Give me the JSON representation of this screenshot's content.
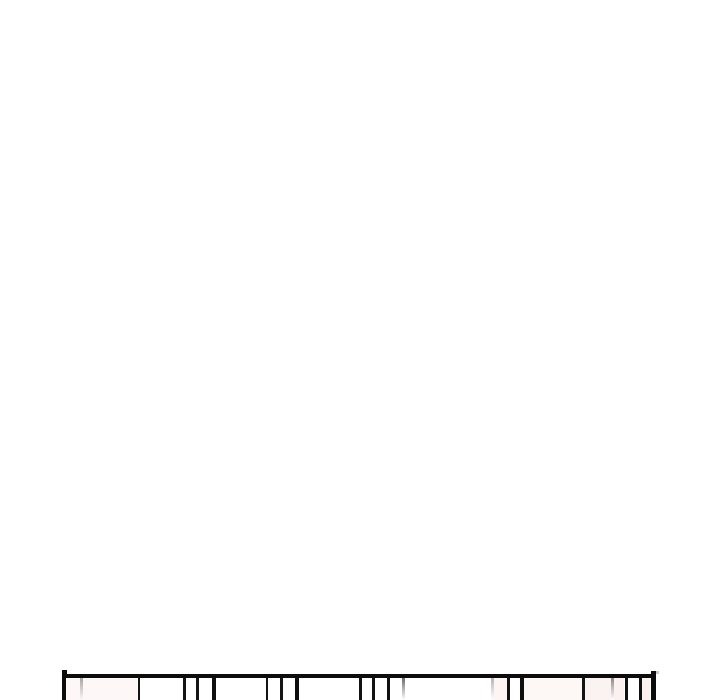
{
  "scene": {
    "kind": "comic-strip-segment",
    "description": "Mostly blank white vertical-scroll comic area; only the hand-drawn top edge of a panel with vertical slat lines is visible at the very bottom, cut off by the image edge.",
    "background_color": "#ffffff"
  },
  "panel": {
    "ink_color": "#0c0c0c",
    "fill_color": "#ffffff",
    "left": 62,
    "top": 674,
    "right": 656,
    "bottom_cropped": true,
    "borders": {
      "top": {
        "x": 62,
        "y": 674,
        "w": 594,
        "h": 4,
        "color": "#0c0c0c"
      },
      "left": {
        "x": 62,
        "y": 670,
        "w": 4.5,
        "h": 30,
        "color": "#0c0c0c"
      },
      "right": {
        "x": 650.5,
        "y": 671,
        "w": 5.5,
        "h": 29,
        "color": "#0c0c0c"
      }
    },
    "corner_notch": {
      "x": 656,
      "y": 671,
      "w": 3,
      "h": 3,
      "color": "#c9c5c5"
    },
    "lines": [
      {
        "x": 79.5,
        "w": 3,
        "color": "#a8a5a5",
        "type": "soft"
      },
      {
        "x": 137.5,
        "w": 2.5,
        "color": "#141414",
        "type": "solid"
      },
      {
        "x": 183,
        "w": 2.5,
        "color": "#141414",
        "type": "solid"
      },
      {
        "x": 196,
        "w": 2.5,
        "color": "#141414",
        "type": "solid"
      },
      {
        "x": 212,
        "w": 3.5,
        "color": "#0f0f0f",
        "type": "solid"
      },
      {
        "x": 265.5,
        "w": 2.5,
        "color": "#141414",
        "type": "solid"
      },
      {
        "x": 280,
        "w": 2.5,
        "color": "#141414",
        "type": "solid"
      },
      {
        "x": 295,
        "w": 3.5,
        "color": "#0f0f0f",
        "type": "solid"
      },
      {
        "x": 358.5,
        "w": 3,
        "color": "#121212",
        "type": "solid"
      },
      {
        "x": 372,
        "w": 3,
        "color": "#121212",
        "type": "solid"
      },
      {
        "x": 386.5,
        "w": 3.5,
        "color": "#101010",
        "type": "solid"
      },
      {
        "x": 401.5,
        "w": 3.5,
        "color": "#6e6a6a",
        "type": "soft"
      },
      {
        "x": 491,
        "w": 2.5,
        "color": "#b7b3b3",
        "type": "soft"
      },
      {
        "x": 507,
        "w": 3,
        "color": "#121212",
        "type": "solid"
      },
      {
        "x": 520,
        "w": 4,
        "color": "#0f0f0f",
        "type": "solid"
      },
      {
        "x": 582,
        "w": 3,
        "color": "#131313",
        "type": "solid"
      },
      {
        "x": 611,
        "w": 3,
        "color": "#8d8888",
        "type": "soft"
      },
      {
        "x": 624.5,
        "w": 3.5,
        "color": "#111111",
        "type": "solid"
      },
      {
        "x": 638.5,
        "w": 3.5,
        "color": "#101010",
        "type": "solid"
      }
    ],
    "tints": [
      {
        "x1": 66,
        "x2": 137,
        "color": "#fdf8f7"
      },
      {
        "x1": 494,
        "x2": 507,
        "color": "#fcf5f4"
      },
      {
        "x1": 524,
        "x2": 582,
        "color": "#fdf7f6"
      },
      {
        "x1": 585,
        "x2": 611,
        "color": "#fbf3f1"
      },
      {
        "x1": 614,
        "x2": 624,
        "color": "#fbf2f0"
      },
      {
        "x1": 642,
        "x2": 650,
        "color": "#faf0ee"
      }
    ]
  }
}
